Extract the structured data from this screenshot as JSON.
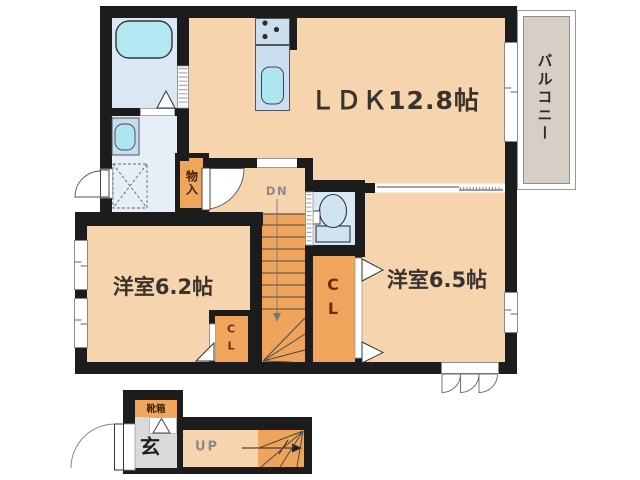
{
  "plan_title": "apartment-floor-plan",
  "labels": {
    "ldk": "ＬＤＫ12.8帖",
    "room_62": "洋室6.2帖",
    "room_65": "洋室6.5帖",
    "balcony": "バルコニー",
    "storage": "物入",
    "closet_large": "CL",
    "closet_small": "CL",
    "stairs_down": "DN",
    "stairs_up": "UP",
    "entrance": "玄",
    "shoebox": "靴箱"
  },
  "colors": {
    "wall": "#1c1c1c",
    "room_peach": "#f6d5ae",
    "wet_blue": "#d9e8f3",
    "washroom_blue": "#e6eff7",
    "tub_cyan": "#b3e7f1",
    "kitchen_blue": "#ccdff0",
    "sink_cyan": "#ade6f1",
    "closet_orange": "#f0a55c",
    "stairs_orange": "#eea45a",
    "balcony_gray": "#d6cfc6",
    "entrance_gray": "#dadada",
    "label_dark": "#3a332c",
    "label_maroon": "#6f2c12",
    "label_gray": "#8a8a8a"
  }
}
